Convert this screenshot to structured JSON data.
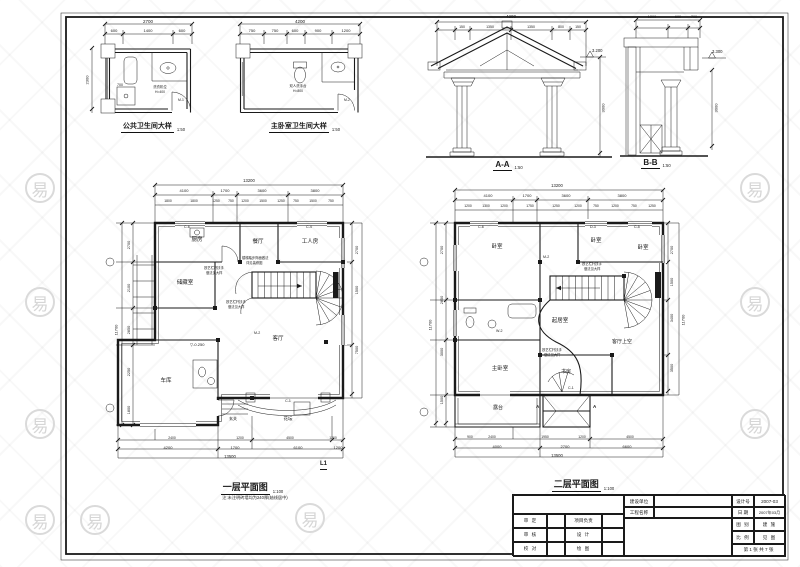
{
  "colors": {
    "ink": "#1a1a1a",
    "paper": "#ffffff",
    "watermark": "#d8d8d8"
  },
  "drawings": {
    "bath_public": {
      "title": "公共卫生间大样",
      "scale": "1:50"
    },
    "bath_master": {
      "title": "主卧室卫生间大样",
      "scale": "1:50"
    },
    "section_a": {
      "title": "A-A",
      "scale": "1:50"
    },
    "section_b": {
      "title": "B-B",
      "scale": "1:50"
    },
    "plan_1f": {
      "title": "一层平面图",
      "scale": "1:100",
      "note": "注:未注明砖墙均为240厚(轴线居中)"
    },
    "plan_2f": {
      "title": "二层平面图",
      "scale": "1:100"
    }
  },
  "title_block": {
    "owner_label": "建设单位",
    "owner_value": "",
    "project_label": "工程名称",
    "project_value": "",
    "design_no_label": "设计号",
    "design_no": "2007-03",
    "date_label": "日 期",
    "date": "2007年03月",
    "category_label": "图 别",
    "category": "建 施",
    "scale_label": "比 例",
    "scale": "见 图",
    "sheet": "第 1 张 共 7 张",
    "row1_left": "审 定",
    "row1_right": "项目负责",
    "row2_left": "审 核",
    "row2_right": "设 计",
    "row3_left": "校 对",
    "row3_right": "绘 图"
  },
  "watermark": {
    "glyph": "易",
    "badges": [
      [
        40,
        188
      ],
      [
        40,
        302
      ],
      [
        40,
        424
      ],
      [
        40,
        520
      ],
      [
        95,
        520
      ],
      [
        310,
        518
      ],
      [
        755,
        188
      ],
      [
        755,
        302
      ],
      [
        755,
        424
      ]
    ]
  },
  "labels": [
    {
      "t": "2700",
      "x": 148,
      "y": 19,
      "s": 4.5,
      "c": 1
    },
    {
      "t": "600",
      "x": 114,
      "y": 29,
      "s": 4,
      "c": 1
    },
    {
      "t": "1400",
      "x": 148,
      "y": 29,
      "s": 4,
      "c": 1
    },
    {
      "t": "600",
      "x": 182,
      "y": 29,
      "s": 4,
      "c": 1
    },
    {
      "t": "2300",
      "x": 88,
      "y": 80,
      "s": 4,
      "v": 1
    },
    {
      "t": "700",
      "x": 120,
      "y": 83,
      "s": 3.6,
      "c": 1
    },
    {
      "t": "洗衣机位",
      "x": 160,
      "y": 86,
      "s": 3.4,
      "c": 1
    },
    {
      "t": "H=400",
      "x": 160,
      "y": 90.5,
      "s": 3.4,
      "c": 1
    },
    {
      "t": "M-1",
      "x": 178,
      "y": 99,
      "s": 3.4
    },
    {
      "t": "4200",
      "x": 300,
      "y": 19,
      "s": 4.5,
      "c": 1
    },
    {
      "t": "750",
      "x": 252,
      "y": 29,
      "s": 4,
      "c": 1
    },
    {
      "t": "750",
      "x": 275,
      "y": 29,
      "s": 4,
      "c": 1
    },
    {
      "t": "600",
      "x": 295,
      "y": 29,
      "s": 4,
      "c": 1
    },
    {
      "t": "900",
      "x": 318,
      "y": 29,
      "s": 4,
      "c": 1
    },
    {
      "t": "1200",
      "x": 346,
      "y": 29,
      "s": 4,
      "c": 1
    },
    {
      "t": "双人洗手台",
      "x": 298,
      "y": 85,
      "s": 3.4,
      "c": 1
    },
    {
      "t": "H=800",
      "x": 298,
      "y": 89.5,
      "s": 3.4,
      "c": 1
    },
    {
      "t": "M-2",
      "x": 344,
      "y": 99,
      "s": 3.4
    },
    {
      "t": "4200",
      "x": 511,
      "y": 14,
      "s": 4.5,
      "c": 1
    },
    {
      "t": "150",
      "x": 462,
      "y": 24.5,
      "s": 3.5,
      "c": 1
    },
    {
      "t": "1350",
      "x": 490,
      "y": 24.5,
      "s": 3.5,
      "c": 1
    },
    {
      "t": "1350",
      "x": 531,
      "y": 24.5,
      "s": 3.5,
      "c": 1
    },
    {
      "t": "800",
      "x": 561,
      "y": 24.5,
      "s": 3.5,
      "c": 1
    },
    {
      "t": "150",
      "x": 578,
      "y": 24.5,
      "s": 3.5,
      "c": 1
    },
    {
      "t": "3.200",
      "x": 592,
      "y": 49,
      "s": 4.2
    },
    {
      "t": "3000",
      "x": 604,
      "y": 108,
      "s": 4,
      "v": 1
    },
    {
      "t": "1200",
      "x": 652,
      "y": 14.5,
      "s": 3.8,
      "c": 1
    },
    {
      "t": "600",
      "x": 678,
      "y": 14.5,
      "s": 3.8,
      "c": 1
    },
    {
      "t": "700",
      "x": 694,
      "y": 14.5,
      "s": 3.8,
      "c": 1
    },
    {
      "t": "3.300",
      "x": 712,
      "y": 50,
      "s": 4.2
    },
    {
      "t": "3000",
      "x": 717,
      "y": 108,
      "s": 4,
      "v": 1
    },
    {
      "t": "13200",
      "x": 249,
      "y": 179,
      "s": 4.2,
      "c": 1
    },
    {
      "t": "4100",
      "x": 184,
      "y": 189,
      "s": 4,
      "c": 1
    },
    {
      "t": "1700",
      "x": 225,
      "y": 189,
      "s": 4,
      "c": 1
    },
    {
      "t": "3600",
      "x": 262,
      "y": 189,
      "s": 4,
      "c": 1
    },
    {
      "t": "3800",
      "x": 315,
      "y": 189,
      "s": 4,
      "c": 1
    },
    {
      "t": "1800",
      "x": 168,
      "y": 199.5,
      "s": 3.4,
      "c": 1
    },
    {
      "t": "1800",
      "x": 194,
      "y": 199.5,
      "s": 3.4,
      "c": 1
    },
    {
      "t": "1250",
      "x": 216,
      "y": 199.5,
      "s": 3.4,
      "c": 1
    },
    {
      "t": "750",
      "x": 231,
      "y": 199.5,
      "s": 3.4,
      "c": 1
    },
    {
      "t": "1200",
      "x": 245,
      "y": 199.5,
      "s": 3.4,
      "c": 1
    },
    {
      "t": "1500",
      "x": 263,
      "y": 199.5,
      "s": 3.4,
      "c": 1
    },
    {
      "t": "1250",
      "x": 281,
      "y": 199.5,
      "s": 3.4,
      "c": 1
    },
    {
      "t": "750",
      "x": 296,
      "y": 199.5,
      "s": 3.4,
      "c": 1
    },
    {
      "t": "1500",
      "x": 313,
      "y": 199.5,
      "s": 3.4,
      "c": 1
    },
    {
      "t": "750",
      "x": 331,
      "y": 199.5,
      "s": 3.4,
      "c": 1
    },
    {
      "t": "2700",
      "x": 129,
      "y": 245,
      "s": 3.8,
      "v": 1
    },
    {
      "t": "2100",
      "x": 129,
      "y": 288,
      "s": 3.8,
      "v": 1
    },
    {
      "t": "2850",
      "x": 129,
      "y": 330,
      "s": 3.8,
      "v": 1
    },
    {
      "t": "2250",
      "x": 129,
      "y": 372,
      "s": 3.8,
      "v": 1
    },
    {
      "t": "1800",
      "x": 129,
      "y": 410,
      "s": 3.8,
      "v": 1
    },
    {
      "t": "11700",
      "x": 117,
      "y": 330,
      "s": 4,
      "v": 1
    },
    {
      "t": "2700",
      "x": 357,
      "y": 250,
      "s": 3.8,
      "v": 1
    },
    {
      "t": "1500",
      "x": 357,
      "y": 290,
      "s": 3.8,
      "v": 1
    },
    {
      "t": "7500",
      "x": 357,
      "y": 350,
      "s": 3.8,
      "v": 1
    },
    {
      "t": "2400",
      "x": 172,
      "y": 436.5,
      "s": 3.4,
      "c": 1
    },
    {
      "t": "1200",
      "x": 240,
      "y": 436.5,
      "s": 3.4,
      "c": 1
    },
    {
      "t": "4500",
      "x": 290,
      "y": 436.5,
      "s": 3.4,
      "c": 1
    },
    {
      "t": "1200",
      "x": 333,
      "y": 436.5,
      "s": 3.4,
      "c": 1
    },
    {
      "t": "4200",
      "x": 168,
      "y": 445.5,
      "s": 4,
      "c": 1
    },
    {
      "t": "1700",
      "x": 235,
      "y": 445.5,
      "s": 4,
      "c": 1
    },
    {
      "t": "6100",
      "x": 298,
      "y": 445.5,
      "s": 4,
      "c": 1
    },
    {
      "t": "1200",
      "x": 338,
      "y": 445.5,
      "s": 4,
      "c": 1
    },
    {
      "t": "13500",
      "x": 230,
      "y": 454.5,
      "s": 4.2,
      "c": 1
    },
    {
      "t": "L1",
      "x": 320,
      "y": 461,
      "s": 6,
      "b": 1,
      "u": 1
    },
    {
      "t": "厨房",
      "x": 197,
      "y": 237,
      "s": 5.5,
      "c": 1
    },
    {
      "t": "储藏室",
      "x": 185,
      "y": 280,
      "s": 5.5,
      "c": 1
    },
    {
      "t": "餐厅",
      "x": 258,
      "y": 239,
      "s": 5.5,
      "c": 1
    },
    {
      "t": "工人房",
      "x": 310,
      "y": 239,
      "s": 5.5,
      "c": 1
    },
    {
      "t": "客厅",
      "x": 278,
      "y": 336,
      "s": 5.5,
      "c": 1
    },
    {
      "t": "车库",
      "x": 166,
      "y": 378,
      "s": 5.5,
      "c": 1
    },
    {
      "t": "玄关",
      "x": 233,
      "y": 417,
      "s": 4,
      "c": 1
    },
    {
      "t": "花坛",
      "x": 288,
      "y": 416,
      "s": 4.5,
      "c": 1
    },
    {
      "t": "C-1",
      "x": 288,
      "y": 399,
      "s": 3.6,
      "c": 1
    },
    {
      "t": "▽-0.250",
      "x": 190,
      "y": 343,
      "s": 4
    },
    {
      "t": "C-6",
      "x": 184,
      "y": 225,
      "s": 3.6
    },
    {
      "t": "C-4",
      "x": 306,
      "y": 225,
      "s": 3.6
    },
    {
      "t": "M-2",
      "x": 254,
      "y": 331,
      "s": 3.6
    },
    {
      "t": "铁艺栏杆扶手",
      "x": 204,
      "y": 267,
      "s": 3.3
    },
    {
      "t": "做法见大样",
      "x": 206,
      "y": 271.5,
      "s": 3.3
    },
    {
      "t": "铁艺栏杆扶手",
      "x": 226,
      "y": 301,
      "s": 3.3
    },
    {
      "t": "做法见大样",
      "x": 228,
      "y": 305.5,
      "s": 3.3
    },
    {
      "t": "楼梯踏步饰面做法",
      "x": 242,
      "y": 257,
      "s": 3.3
    },
    {
      "t": "详见装修图",
      "x": 246,
      "y": 261.5,
      "s": 3.3
    },
    {
      "t": "13200",
      "x": 557,
      "y": 184,
      "s": 4.2,
      "c": 1
    },
    {
      "t": "4100",
      "x": 488,
      "y": 194,
      "s": 4,
      "c": 1
    },
    {
      "t": "1700",
      "x": 527,
      "y": 194,
      "s": 4,
      "c": 1
    },
    {
      "t": "3600",
      "x": 566,
      "y": 194,
      "s": 4,
      "c": 1
    },
    {
      "t": "3800",
      "x": 622,
      "y": 194,
      "s": 4,
      "c": 1
    },
    {
      "t": "1200",
      "x": 468,
      "y": 204.5,
      "s": 3.4,
      "c": 1
    },
    {
      "t": "1300",
      "x": 486,
      "y": 204.5,
      "s": 3.4,
      "c": 1
    },
    {
      "t": "1200",
      "x": 504,
      "y": 204.5,
      "s": 3.4,
      "c": 1
    },
    {
      "t": "1750",
      "x": 530,
      "y": 204.5,
      "s": 3.4,
      "c": 1
    },
    {
      "t": "1250",
      "x": 556,
      "y": 204.5,
      "s": 3.4,
      "c": 1
    },
    {
      "t": "1200",
      "x": 578,
      "y": 204.5,
      "s": 3.4,
      "c": 1
    },
    {
      "t": "750",
      "x": 596,
      "y": 204.5,
      "s": 3.4,
      "c": 1
    },
    {
      "t": "1200",
      "x": 615,
      "y": 204.5,
      "s": 3.4,
      "c": 1
    },
    {
      "t": "750",
      "x": 634,
      "y": 204.5,
      "s": 3.4,
      "c": 1
    },
    {
      "t": "1250",
      "x": 652,
      "y": 204.5,
      "s": 3.4,
      "c": 1
    },
    {
      "t": "2700",
      "x": 442,
      "y": 250,
      "s": 3.8,
      "v": 1
    },
    {
      "t": "2850",
      "x": 442,
      "y": 300,
      "s": 3.8,
      "v": 1
    },
    {
      "t": "3000",
      "x": 442,
      "y": 352,
      "s": 3.8,
      "v": 1
    },
    {
      "t": "1500",
      "x": 442,
      "y": 400,
      "s": 3.8,
      "v": 1
    },
    {
      "t": "11700",
      "x": 431,
      "y": 325,
      "s": 4,
      "v": 1
    },
    {
      "t": "2700",
      "x": 672,
      "y": 250,
      "s": 3.8,
      "v": 1
    },
    {
      "t": "1500",
      "x": 672,
      "y": 282,
      "s": 3.8,
      "v": 1
    },
    {
      "t": "3400",
      "x": 672,
      "y": 318,
      "s": 3.8,
      "v": 1
    },
    {
      "t": "3500",
      "x": 672,
      "y": 368,
      "s": 3.8,
      "v": 1
    },
    {
      "t": "11700",
      "x": 684,
      "y": 320,
      "s": 4,
      "v": 1
    },
    {
      "t": "900",
      "x": 470,
      "y": 435.5,
      "s": 3.4,
      "c": 1
    },
    {
      "t": "2400",
      "x": 492,
      "y": 435.5,
      "s": 3.4,
      "c": 1
    },
    {
      "t": "1950",
      "x": 545,
      "y": 435.5,
      "s": 3.4,
      "c": 1
    },
    {
      "t": "1200",
      "x": 582,
      "y": 435.5,
      "s": 3.4,
      "c": 1
    },
    {
      "t": "4500",
      "x": 630,
      "y": 435.5,
      "s": 3.4,
      "c": 1
    },
    {
      "t": "4000",
      "x": 497,
      "y": 444.5,
      "s": 4,
      "c": 1
    },
    {
      "t": "2700",
      "x": 565,
      "y": 444.5,
      "s": 4,
      "c": 1
    },
    {
      "t": "6600",
      "x": 627,
      "y": 444.5,
      "s": 4,
      "c": 1
    },
    {
      "t": "13500",
      "x": 557,
      "y": 453.5,
      "s": 4.2,
      "c": 1
    },
    {
      "t": "卧室",
      "x": 497,
      "y": 244,
      "s": 5.5,
      "c": 1
    },
    {
      "t": "卧室",
      "x": 596,
      "y": 238,
      "s": 5.5,
      "c": 1
    },
    {
      "t": "卧室",
      "x": 643,
      "y": 245,
      "s": 5.5,
      "c": 1
    },
    {
      "t": "起居室",
      "x": 560,
      "y": 318,
      "s": 5.5,
      "c": 1
    },
    {
      "t": "主卧室",
      "x": 500,
      "y": 366,
      "s": 5.5,
      "c": 1
    },
    {
      "t": "书房",
      "x": 566,
      "y": 370,
      "s": 5,
      "c": 1
    },
    {
      "t": "露台",
      "x": 498,
      "y": 406,
      "s": 5,
      "c": 1
    },
    {
      "t": "客厅上空",
      "x": 622,
      "y": 340,
      "s": 5,
      "c": 1
    },
    {
      "t": "C-6",
      "x": 478,
      "y": 225,
      "s": 3.6
    },
    {
      "t": "D-3",
      "x": 590,
      "y": 225,
      "s": 3.6
    },
    {
      "t": "C-5",
      "x": 634,
      "y": 225,
      "s": 3.6
    },
    {
      "t": "M-2",
      "x": 543,
      "y": 255,
      "s": 3.6
    },
    {
      "t": "W-2",
      "x": 496,
      "y": 329,
      "s": 3.6
    },
    {
      "t": "C-1",
      "x": 568,
      "y": 386,
      "s": 3.6
    },
    {
      "t": "A",
      "x": 536,
      "y": 404,
      "s": 4.5,
      "b": 1
    },
    {
      "t": "A",
      "x": 593,
      "y": 404,
      "s": 4.5,
      "b": 1
    },
    {
      "t": "铁艺栏杆扶手",
      "x": 582,
      "y": 263,
      "s": 3.3
    },
    {
      "t": "做法见大样",
      "x": 584,
      "y": 267.5,
      "s": 3.3
    },
    {
      "t": "铁艺栏杆扶手",
      "x": 542,
      "y": 349,
      "s": 3.3
    },
    {
      "t": "做法见大样",
      "x": 544,
      "y": 353.5,
      "s": 3.3
    }
  ]
}
